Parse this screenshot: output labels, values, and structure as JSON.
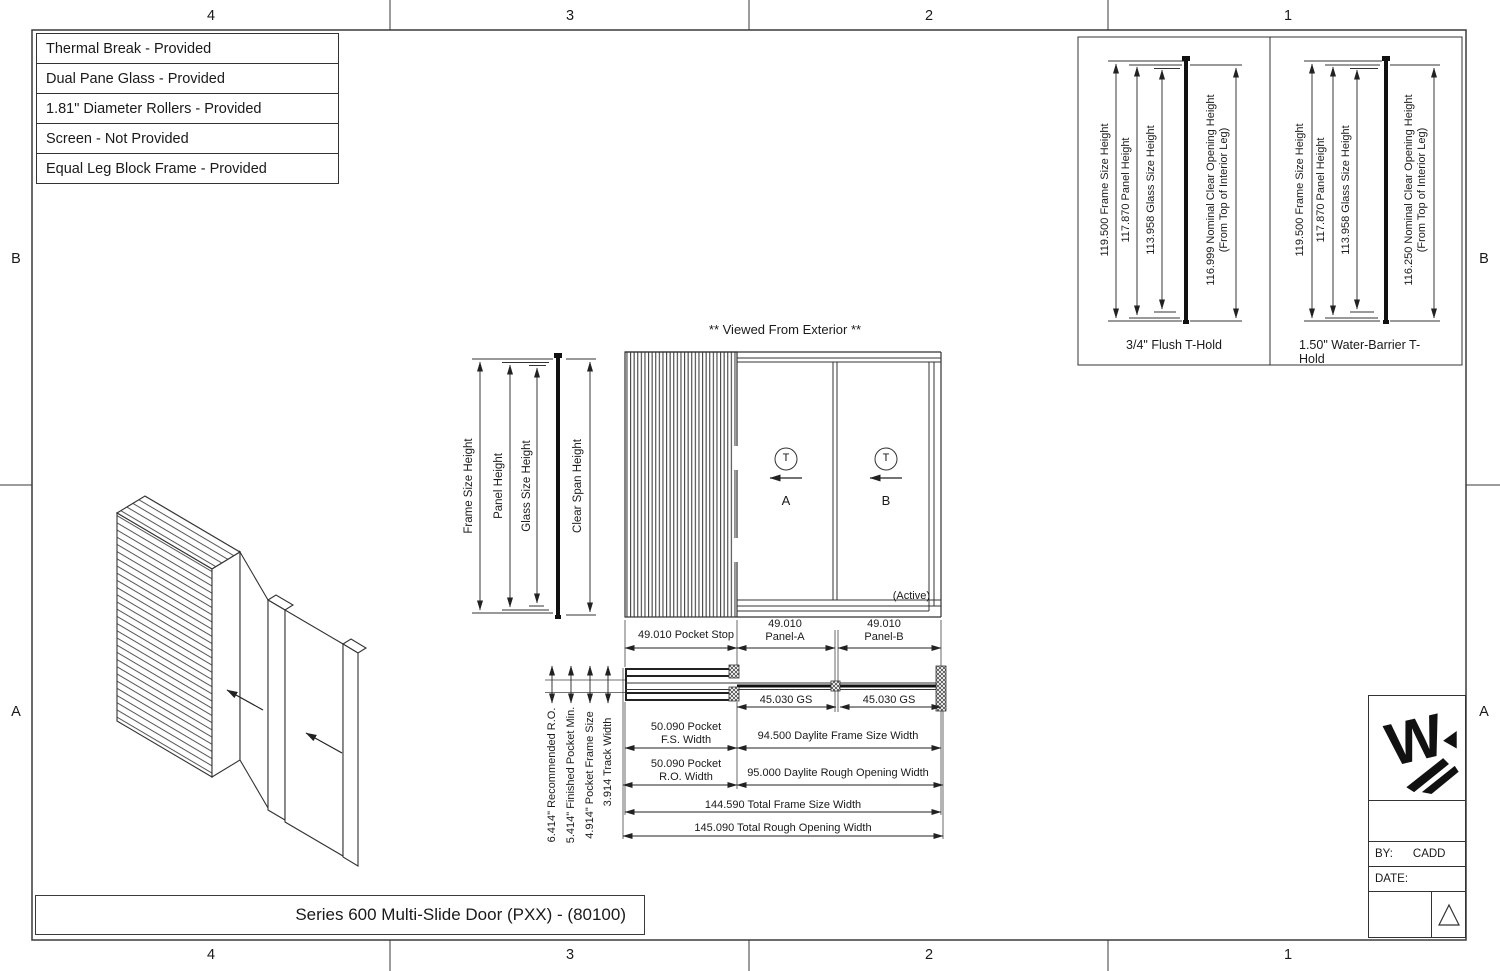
{
  "sheet": {
    "zones": {
      "top": [
        "4",
        "3",
        "2",
        "1"
      ],
      "bottom": [
        "4",
        "3",
        "2",
        "1"
      ],
      "left": [
        "B",
        "A"
      ],
      "right": [
        "B",
        "A"
      ]
    }
  },
  "feature_table": {
    "rows": [
      "Thermal Break - Provided",
      "Dual Pane Glass - Provided",
      "1.81\" Diameter Rollers - Provided",
      "Screen - Not Provided",
      "Equal Leg Block Frame - Provided"
    ]
  },
  "detail_views": [
    {
      "caption": "3/4\" Flush T-Hold",
      "frame_size_dim": "119.500 Frame Size Height",
      "panel_dim": "117.870 Panel Height",
      "glass_dim": "113.958 Glass Size Height",
      "clear_opening_dim": "116.999 Nominal Clear Opening Height",
      "clear_opening_note": "(From Top of Interior Leg)"
    },
    {
      "caption": "1.50\" Water-Barrier T-Hold",
      "frame_size_dim": "119.500 Frame Size Height",
      "panel_dim": "117.870 Panel Height",
      "glass_dim": "113.958 Glass Size Height",
      "clear_opening_dim": "116.250 Nominal Clear Opening Height",
      "clear_opening_note": "(From Top of Interior Leg)"
    }
  ],
  "elevation": {
    "view_title": "** Viewed From Exterior **",
    "frame_size_height_label": "Frame Size Height",
    "panel_height_label": "Panel Height",
    "glass_size_height_label": "Glass Size Height",
    "clear_span_height_label": "Clear Span Height",
    "panel_a_symbol": "T",
    "panel_a_label": "A",
    "panel_b_symbol": "T",
    "panel_b_label": "B",
    "active_note": "(Active)"
  },
  "plan": {
    "pocket_stop_dim": "49.010 Pocket Stop",
    "panel_a_dim": "49.010",
    "panel_a_name": "Panel-A",
    "panel_b_dim": "49.010",
    "panel_b_name": "Panel-B",
    "gs_a_dim": "45.030 GS",
    "gs_b_dim": "45.030 GS",
    "recommended_ro_dim": "6.414\" Recommended R.O.",
    "finished_pocket_dim": "5.414\" Finished Pocket Min.",
    "pocket_frame_dim": "4.914\" Pocket Frame Size",
    "track_width_dim": "3.914 Track Width",
    "pocket_fs_dim_line1": "50.090 Pocket",
    "pocket_fs_dim_line2": "F.S. Width",
    "daylite_fs_dim": "94.500 Daylite Frame Size Width",
    "pocket_ro_dim_line1": "50.090 Pocket",
    "pocket_ro_dim_line2": "R.O. Width",
    "daylite_ro_dim": "95.000 Daylite Rough Opening Width",
    "total_fs_dim": "144.590 Total Frame Size Width",
    "total_ro_dim": "145.090 Total Rough Opening Width"
  },
  "title_bar": {
    "title": "Series 600 Multi-Slide Door (PXX) - (80100)"
  },
  "title_block": {
    "by_label": "BY:",
    "by_value": "CADD",
    "date_label": "DATE:"
  },
  "colors": {
    "line": "#333333",
    "text": "#1a1a1a",
    "background": "#ffffff"
  }
}
